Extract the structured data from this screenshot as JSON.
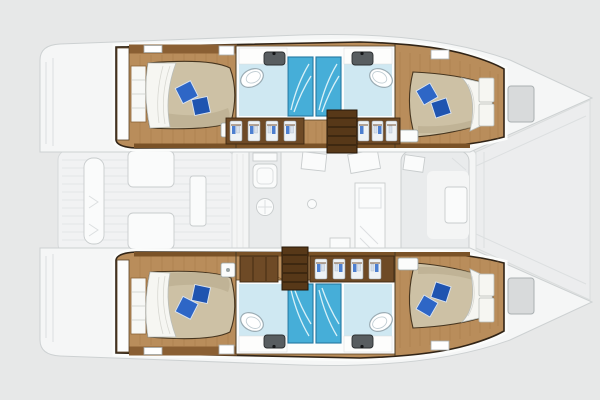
{
  "diagram": {
    "type": "boat-floor-plan",
    "vessel": "catamaran",
    "orientation": "bow-right",
    "hulls": 2,
    "features": {
      "double_cabins": 4,
      "bathrooms": 4,
      "separate_showers": 4,
      "companionway_stairs": 2
    },
    "areas": [
      "aft-cabin-port",
      "bathroom-port-aft",
      "shower-port-aft",
      "shower-port-fwd",
      "bathroom-port-fwd",
      "corridor-wardrobes-port",
      "forward-cabin-port",
      "aft-cabin-starboard",
      "bathroom-starboard-aft",
      "shower-starboard-aft",
      "shower-starboard-fwd",
      "bathroom-starboard-fwd",
      "corridor-wardrobes-starboard",
      "forward-cabin-starboard",
      "salon-galley",
      "dinette",
      "nav-seat",
      "cockpit",
      "stern-platform",
      "foredeck-trampoline",
      "bow-deck"
    ]
  },
  "palette": {
    "bg": "#e7e8e8",
    "ghost_fill": "#f5f6f6",
    "ghost_stroke": "#cdd1d2",
    "ghost_line": "#dcdfe0",
    "ghost_furn": "#fafbfb",
    "ghost_furn_stroke": "#c8cccd",
    "tramp_fill": "#ecedee",
    "halo": "#fbfcfb",
    "outline_dark": "#312416",
    "wood_floor": "#b98d5b",
    "wood_plank": "#a27848",
    "wood_band": "#8a5f33",
    "wood_edge": "#7a5227",
    "cabinet": "#6e4a26",
    "cabinet_stroke": "#3e2912",
    "stairs": "#573818",
    "stairs_tread": "#2f1e0c",
    "wall_white": "#fcfdfd",
    "wall_stroke": "#5b4427",
    "shelf_white": "#f7f8f6",
    "bed_duvet": "#cdc1a5",
    "bed_shade": "#b9ac8e",
    "bed_outline": "#46351f",
    "sheet": "#f6f6f2",
    "sheet_stroke": "#b9bdb9",
    "pillow": "#2e66c6",
    "pillow_deep": "#1f54b0",
    "pillow_stroke": "#d9e4f4",
    "bath_floor": "#cfe8f2",
    "shower": "#46aed8",
    "shower_stroke": "#2478a2",
    "shower_streak": "#e8f7fb",
    "sink": "#585d60",
    "sink_stroke": "#2b2e30",
    "toilet_stroke": "#9cadb5",
    "door_arc": "#8a6336",
    "hatch_fill": "#d8dadb",
    "hatch_stroke": "#aab0b2"
  }
}
